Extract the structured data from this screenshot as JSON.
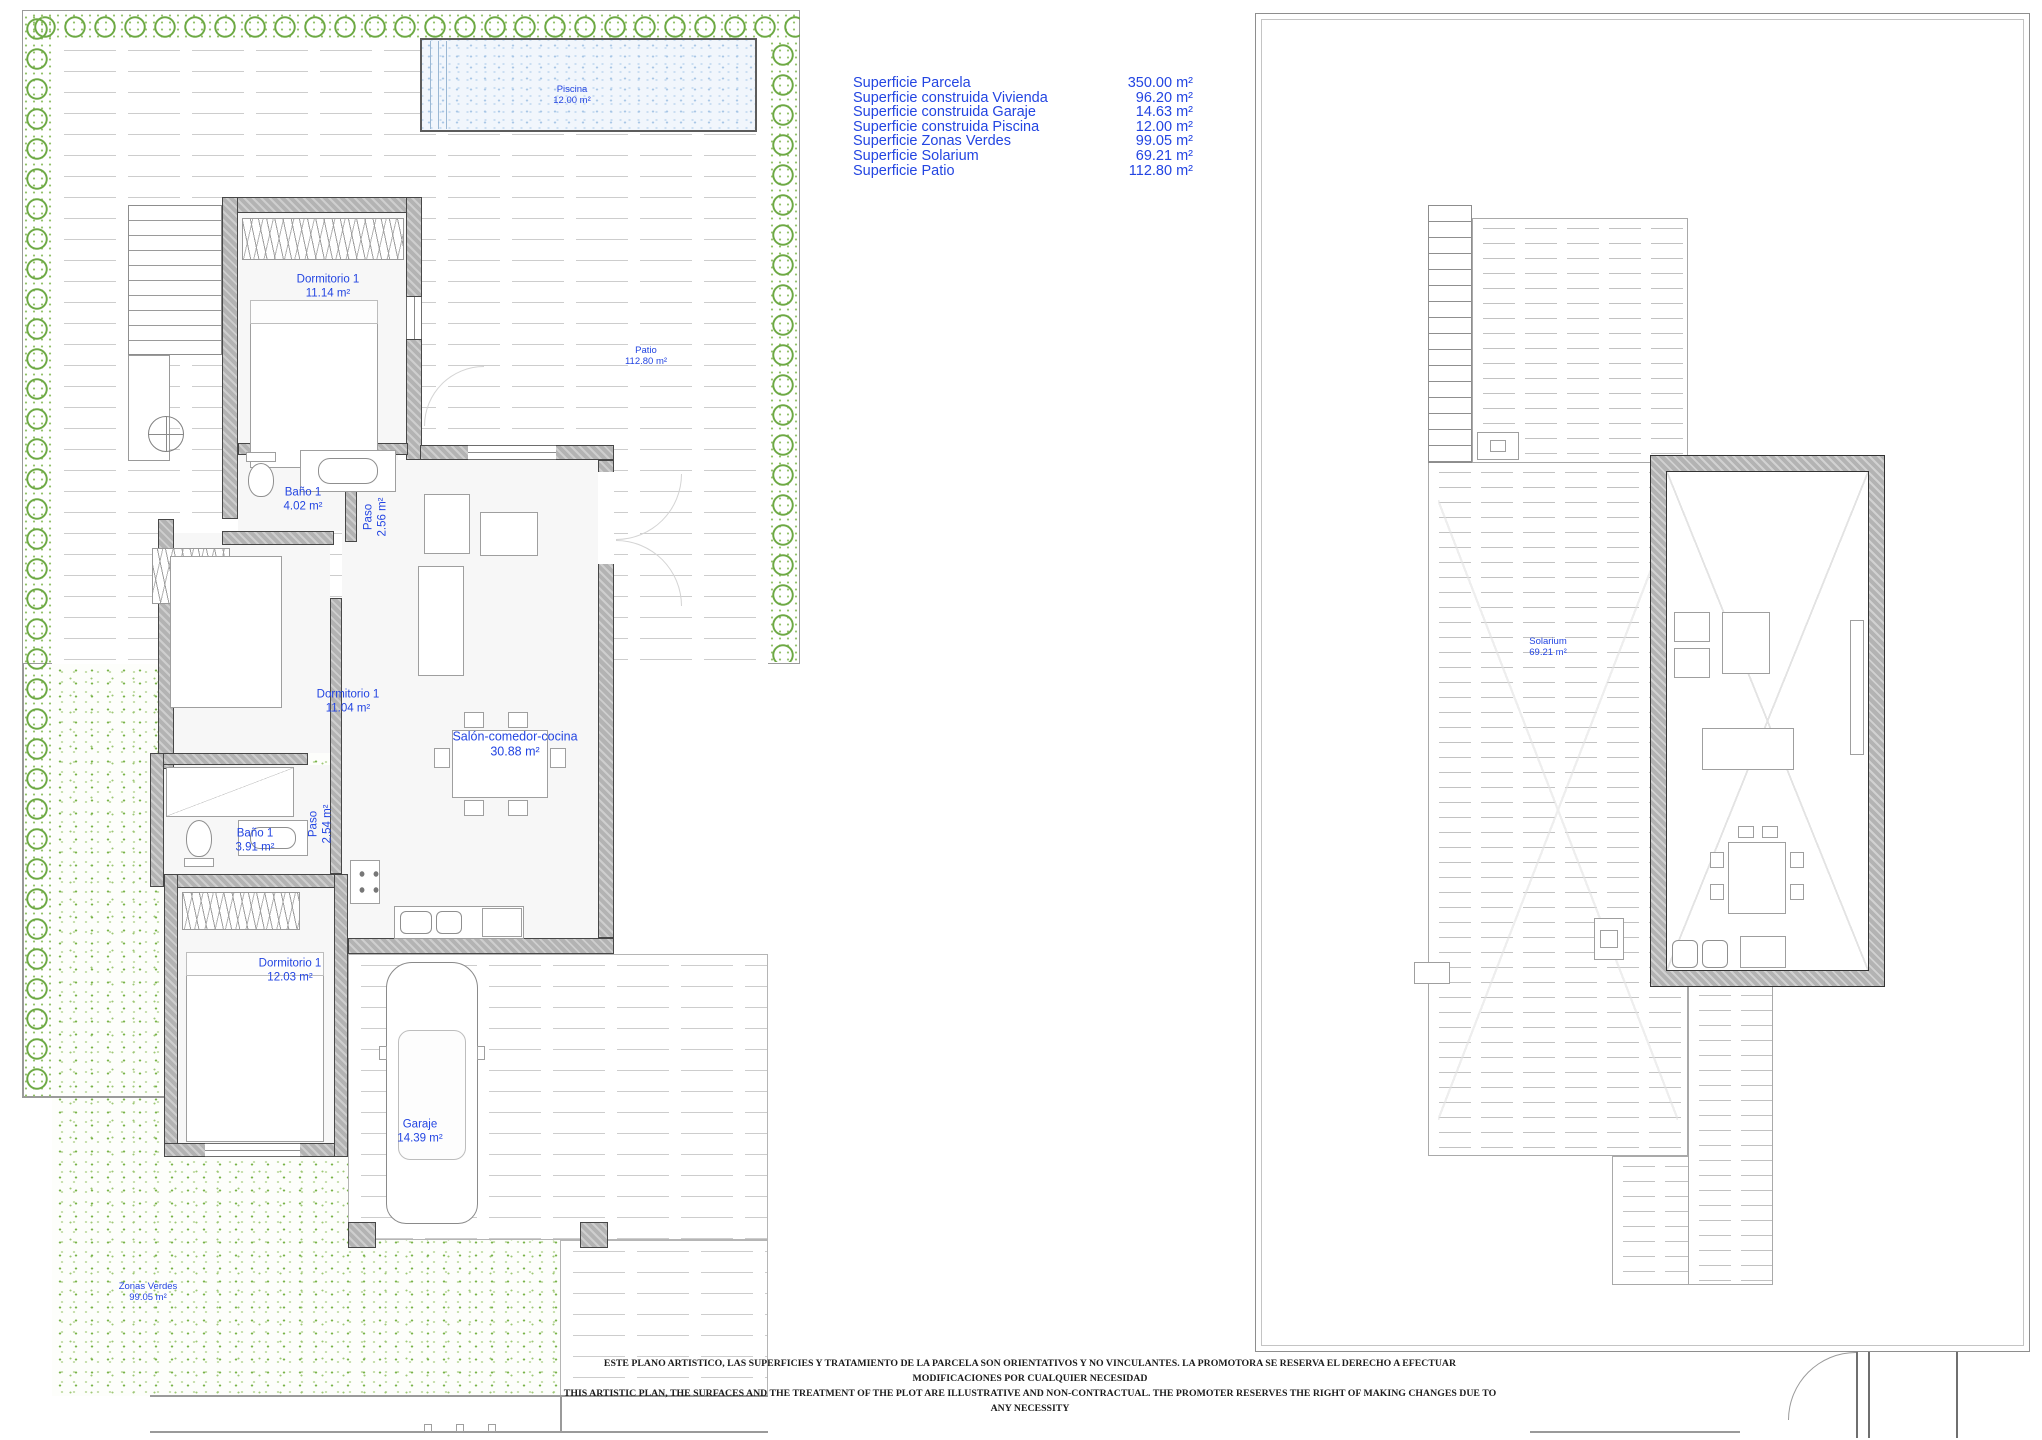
{
  "summary_table": {
    "text_color": "#2345e2",
    "rows": [
      {
        "label": "Superficie Parcela",
        "value": "350.00 m²"
      },
      {
        "label": "Superficie construida Vivienda",
        "value": "96.20 m²"
      },
      {
        "label": "Superficie construida Garaje",
        "value": "14.63 m²"
      },
      {
        "label": "Superficie construida Piscina",
        "value": "12.00 m²"
      },
      {
        "label": "Superficie Zonas Verdes",
        "value": "99.05 m²"
      },
      {
        "label": "Superficie Solarium",
        "value": "69.21 m²"
      },
      {
        "label": "Superficie Patio",
        "value": "112.80 m²"
      }
    ]
  },
  "ground_floor": {
    "rooms": {
      "piscina": {
        "name": "Piscina",
        "area": "12.00 m²"
      },
      "patio": {
        "name": "Patio",
        "area": "112.80 m²"
      },
      "dormitorio_norte": {
        "name": "Dormitorio 1",
        "area": "11.14 m²"
      },
      "bano_norte": {
        "name": "Baño 1",
        "area": "4.02 m²"
      },
      "paso_norte": {
        "name": "Paso",
        "area": "2.56 m²"
      },
      "dormitorio_centro": {
        "name": "Dormitorio 1",
        "area": "11.04 m²"
      },
      "salon": {
        "name": "Salón-comedor-cocina",
        "area": "30.88 m²"
      },
      "bano_sur": {
        "name": "Baño 1",
        "area": "3.91 m²"
      },
      "paso_sur": {
        "name": "Paso",
        "area": "2.54 m²"
      },
      "dormitorio_sur": {
        "name": "Dormitorio 1",
        "area": "12.03 m²"
      },
      "garaje": {
        "name": "Garaje",
        "area": "14.39 m²"
      },
      "zonas_verdes": {
        "name": "Zonas Verdes",
        "area": "99.05 m²"
      }
    }
  },
  "solarium_floor": {
    "rooms": {
      "solarium": {
        "name": "Solarium",
        "area": "69.21 m²"
      }
    }
  },
  "disclaimer": {
    "line_es": "ESTE PLANO ARTISTICO, LAS SUPERFICIES Y TRATAMIENTO DE LA PARCELA SON ORIENTATIVOS Y NO VINCULANTES. LA PROMOTORA SE RESERVA EL DERECHO A EFECTUAR MODIFICACIONES POR CUALQUIER NECESIDAD",
    "line_en": "THIS ARTISTIC PLAN, THE SURFACES AND THE TREATMENT OF THE PLOT ARE ILLUSTRATIVE AND NON-CONTRACTUAL. THE PROMOTER RESERVES THE RIGHT OF MAKING CHANGES DUE TO ANY NECESSITY"
  }
}
